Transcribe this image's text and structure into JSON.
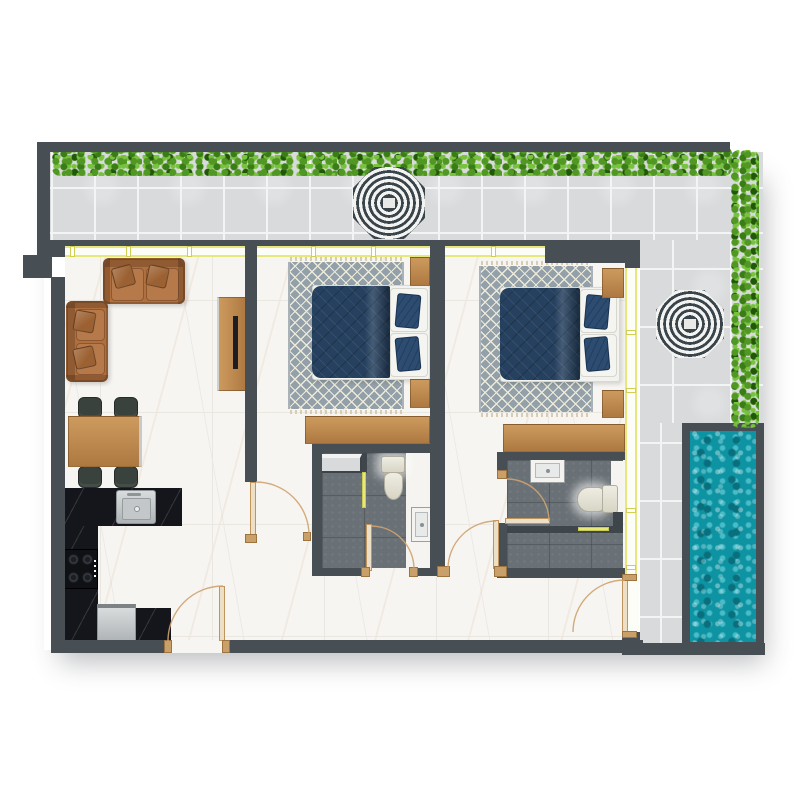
{
  "meta": {
    "image_type": "architectural-floor-plan",
    "view": "top-down rendered plan",
    "unit_summary": "two-bedroom apartment with en-suite bathrooms, open living-dining-kitchen, wrap-around tiled terrace with hedges, two parasols and a plunge pool",
    "text_labels": []
  },
  "colors": {
    "wall": "#474e54",
    "wallDark": "#3f464b",
    "terraceTile": "#d8dadb",
    "terraceGrout": "#f3f4f4",
    "hedgeDark": "#3e7a1d",
    "hedgeMid": "#55952b",
    "hedgeLight": "#7cc147",
    "hedgeDeep": "#24550e",
    "umbrellaDark": "#3a444b",
    "umbrellaLight": "#f3f3f1",
    "poolWater": "#0e93a2",
    "poolDeep": "#0a6f7d",
    "poolLight": "#49bcc8",
    "marble": "#f7f5f1",
    "marbleSeam": "#eae6e0",
    "wood": "#cd9a5e",
    "woodDark": "#ad7941",
    "sofa": "#b06f3d",
    "sofaPillow": "#9c6132",
    "chair": "#3a423e",
    "chairDark": "#252b28",
    "counter": "#15161b",
    "rug": "#93a0a9",
    "rugLattice": "#ecead9",
    "rugFringe": "#d6cdb4",
    "duvet": "#26415f",
    "duvetDark": "#1a3150",
    "pillowNavy": "#2c4c72",
    "sheet": "#f2f2ee",
    "bathTile": "#6a7176",
    "glassYellow": "#e7e87c",
    "glassPale": "#fdfdf8",
    "doorTan": "#c9a06a",
    "arcTan": "#cfa36f"
  },
  "rooms": [
    {
      "id": "terrace",
      "features": [
        "hedge-top",
        "hedge-right",
        "parasol",
        "parasol",
        "plunge-pool",
        "tile-paving"
      ]
    },
    {
      "id": "living-dining",
      "furniture": [
        "two-seater-sofa",
        "two-seater-sofa",
        "tv-unit",
        "dining-table",
        "dining-chairs-x4"
      ]
    },
    {
      "id": "kitchen",
      "furniture": [
        "l-shaped-black-counter",
        "sink",
        "cooktop-4-burner",
        "dishwasher",
        "base-cabinet"
      ]
    },
    {
      "id": "bedroom-1",
      "furniture": [
        "double-bed",
        "area-rug",
        "nightstand",
        "nightstand",
        "desk"
      ]
    },
    {
      "id": "bathroom-1",
      "furniture": [
        "toilet",
        "washbasin",
        "shower-screen",
        "storage-shelf"
      ]
    },
    {
      "id": "bedroom-2",
      "furniture": [
        "double-bed",
        "area-rug",
        "nightstand",
        "nightstand",
        "desk"
      ]
    },
    {
      "id": "bathroom-2",
      "furniture": [
        "toilet",
        "washbasin",
        "shower-screen"
      ]
    },
    {
      "id": "hallway",
      "features": [
        "entry-door",
        "terrace-door"
      ]
    }
  ],
  "door_count": 6,
  "window_sections": 4
}
